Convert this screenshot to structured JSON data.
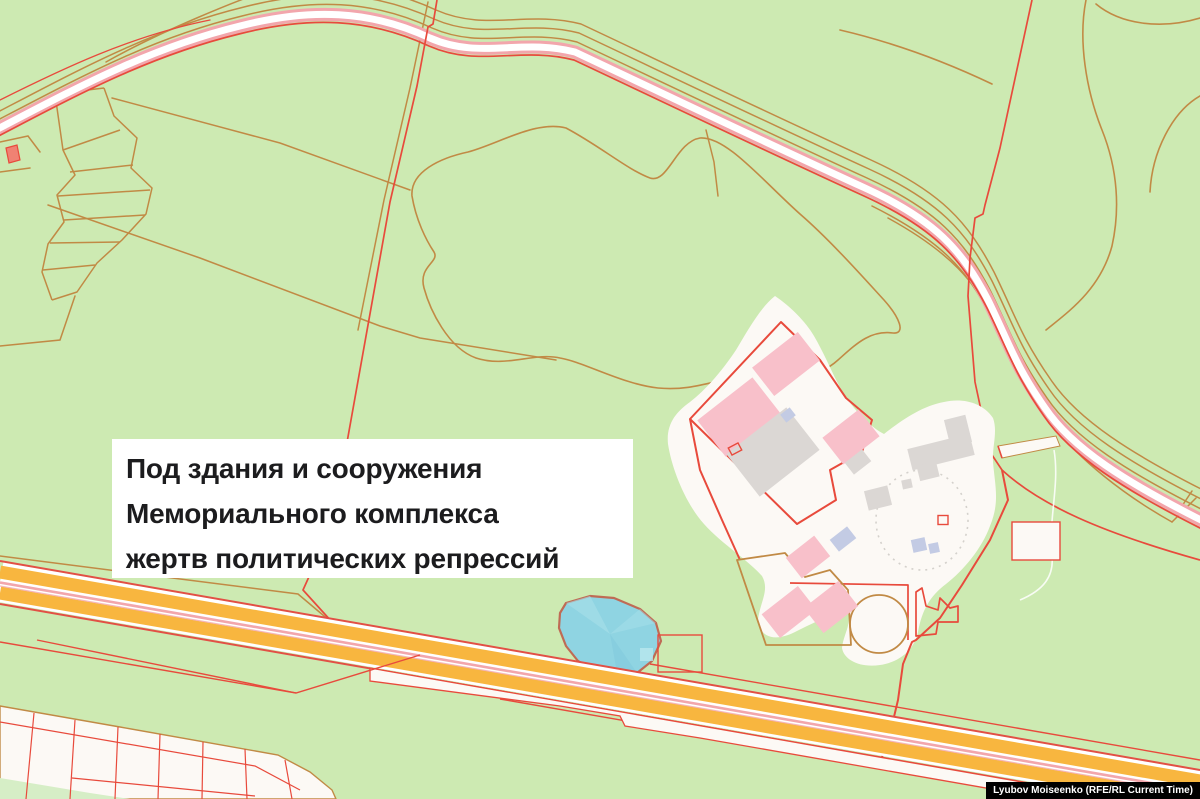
{
  "annotation": {
    "full_text": "Под здания и сооружения Мемориального комплекса жертв политических репрессий",
    "lines": [
      "Под здания и сооружения",
      "Мемориального комплекса",
      "жертв политических репрессий"
    ]
  },
  "credit": {
    "text": "Lyubov Moiseenko (RFE/RL Current Time)"
  },
  "palette": {
    "land_green": "#cdeab2",
    "cadastral_red": "#e84a3c",
    "boundary_orange": "#c18a45",
    "highway_orange": "#f8b63f",
    "road_pink": "#f2a6ac",
    "road_white": "#ffffff",
    "water_fill": "#8fd4e2",
    "water_outline": "#bf6b55",
    "area_white": "#fcf9f5",
    "building_pink": "#f8c0ca",
    "building_gray": "#dbd7d4",
    "building_lavender": "#c3cbe4",
    "annotation_bg": "#ffffff",
    "annotation_text": "#1c1c1e",
    "credit_bg": "#000000",
    "credit_text": "#ffffff"
  },
  "map_features": [
    {
      "name": "memorial-complex-area",
      "kind": "land-parcel",
      "color": "#fcf9f5"
    },
    {
      "name": "pond",
      "kind": "water",
      "color": "#8fd4e2"
    },
    {
      "name": "highway",
      "kind": "dual-carriageway",
      "color": "#f8b63f"
    },
    {
      "name": "secondary-road",
      "kind": "road",
      "color": "#ffffff"
    },
    {
      "name": "cadastral-boundaries",
      "kind": "boundary-lines",
      "color": "#e84a3c"
    },
    {
      "name": "landuse-boundaries",
      "kind": "boundary-lines",
      "color": "#c18a45"
    }
  ],
  "buildings": [
    {
      "type": "pink",
      "cx": 786,
      "cy": 364,
      "w": 58,
      "h": 36,
      "rot": -38
    },
    {
      "type": "pink",
      "cx": 739,
      "cy": 417,
      "w": 70,
      "h": 46,
      "rot": -38
    },
    {
      "type": "pink",
      "cx": 851,
      "cy": 437,
      "w": 46,
      "h": 34,
      "rot": -38
    },
    {
      "type": "pink",
      "cx": 808,
      "cy": 557,
      "w": 36,
      "h": 26,
      "rot": -38
    },
    {
      "type": "pink",
      "cx": 789,
      "cy": 612,
      "w": 46,
      "h": 30,
      "rot": -38
    },
    {
      "type": "pink",
      "cx": 831,
      "cy": 607,
      "w": 44,
      "h": 32,
      "rot": -38
    },
    {
      "type": "gray",
      "cx": 773,
      "cy": 452,
      "w": 76,
      "h": 54,
      "rot": -38
    },
    {
      "type": "gray",
      "cx": 858,
      "cy": 462,
      "w": 22,
      "h": 15,
      "rot": -38
    },
    {
      "type": "gray",
      "cx": 878,
      "cy": 498,
      "w": 24,
      "h": 20,
      "rot": -14
    },
    {
      "type": "gray",
      "cx": 907,
      "cy": 484,
      "w": 10,
      "h": 9,
      "rot": -12
    },
    {
      "type": "gray",
      "cx": 941,
      "cy": 452,
      "w": 64,
      "h": 22,
      "rot": -14
    },
    {
      "type": "gray",
      "cx": 958,
      "cy": 431,
      "w": 22,
      "h": 28,
      "rot": -14
    },
    {
      "type": "gray",
      "cx": 928,
      "cy": 471,
      "w": 20,
      "h": 16,
      "rot": -14
    },
    {
      "type": "gray",
      "cx": 1033,
      "cy": 542,
      "w": 30,
      "h": 11,
      "rot": 52
    },
    {
      "type": "lavender",
      "cx": 788,
      "cy": 415,
      "w": 12,
      "h": 10,
      "rot": -38
    },
    {
      "type": "lavender",
      "cx": 843,
      "cy": 539,
      "w": 22,
      "h": 15,
      "rot": -38
    },
    {
      "type": "lavender",
      "cx": 919,
      "cy": 545,
      "w": 14,
      "h": 13,
      "rot": -12
    },
    {
      "type": "lavender",
      "cx": 934,
      "cy": 548,
      "w": 10,
      "h": 10,
      "rot": -12
    },
    {
      "type": "outline",
      "cx": 735,
      "cy": 449,
      "w": 11,
      "h": 8,
      "rot": -28
    },
    {
      "type": "outline",
      "cx": 943,
      "cy": 520,
      "w": 10,
      "h": 9,
      "rot": 0
    }
  ]
}
